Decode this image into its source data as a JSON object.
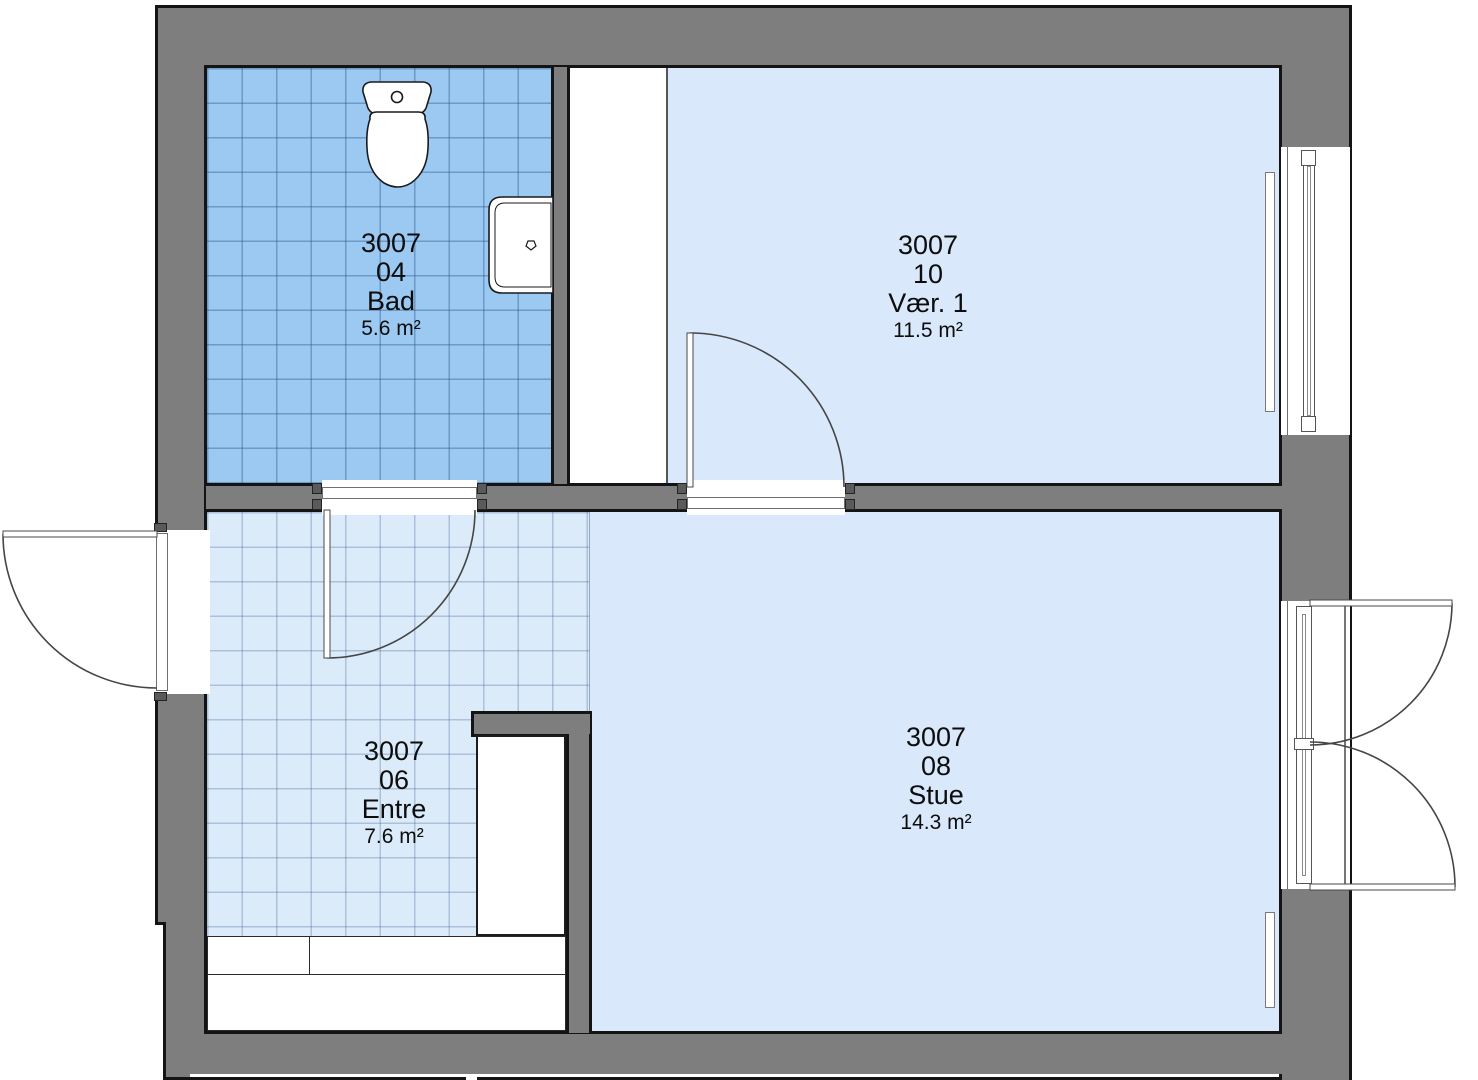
{
  "plan": {
    "title": "Apartment floor plan",
    "rooms": [
      {
        "building": "3007",
        "number": "04",
        "name": "Bad",
        "area": "5.6 m²"
      },
      {
        "building": "3007",
        "number": "10",
        "name": "Vær. 1",
        "area": "11.5 m²"
      },
      {
        "building": "3007",
        "number": "06",
        "name": "Entre",
        "area": "7.6 m²"
      },
      {
        "building": "3007",
        "number": "08",
        "name": "Stue",
        "area": "14.3 m²"
      }
    ],
    "fixtures": [
      "toilet",
      "sink",
      "radiator",
      "wardrobe"
    ],
    "colors": {
      "wall_fill": "#7e7e7e",
      "wall_outline": "#141414",
      "bathroom_floor": "#9bc9f2",
      "bathroom_grid": "#5c7ea6",
      "entre_floor": "#dcebfa",
      "entre_grid": "#8fa8c4",
      "room_floor": "#d9e8fa",
      "label_text": "#0d0d0d"
    }
  }
}
